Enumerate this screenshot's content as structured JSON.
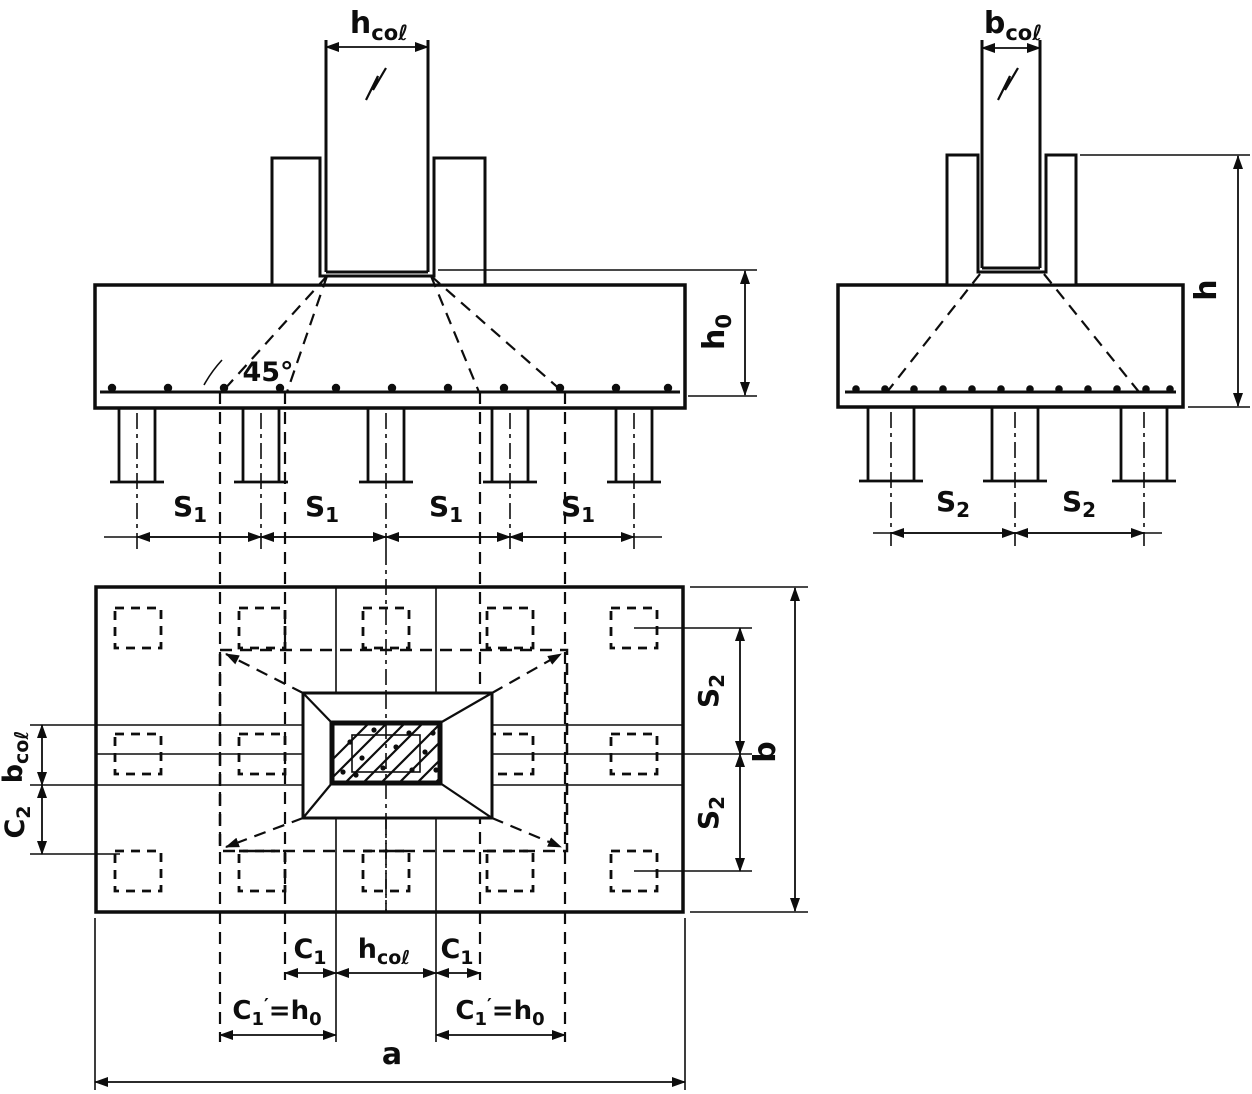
{
  "colors": {
    "ink": "#0d0d0d",
    "paper": "#ffffff"
  },
  "labels": {
    "hcol": {
      "base": "h",
      "sub": "coℓ"
    },
    "bcol": {
      "base": "b",
      "sub": "coℓ"
    },
    "angle": "45°",
    "h0": {
      "base": "h",
      "sub": "0"
    },
    "h": "h",
    "s1": {
      "base": "S",
      "sub": "1"
    },
    "s2": {
      "base": "S",
      "sub": "2"
    },
    "b": "b",
    "c2": {
      "base": "C",
      "sub": "2"
    },
    "c1": {
      "base": "C",
      "sub": "1"
    },
    "c1ph0": {
      "base": "C",
      "sub": "1",
      "prime": "′",
      "eq": "=",
      "base2": "h",
      "sub2": "0"
    },
    "a": "a"
  }
}
